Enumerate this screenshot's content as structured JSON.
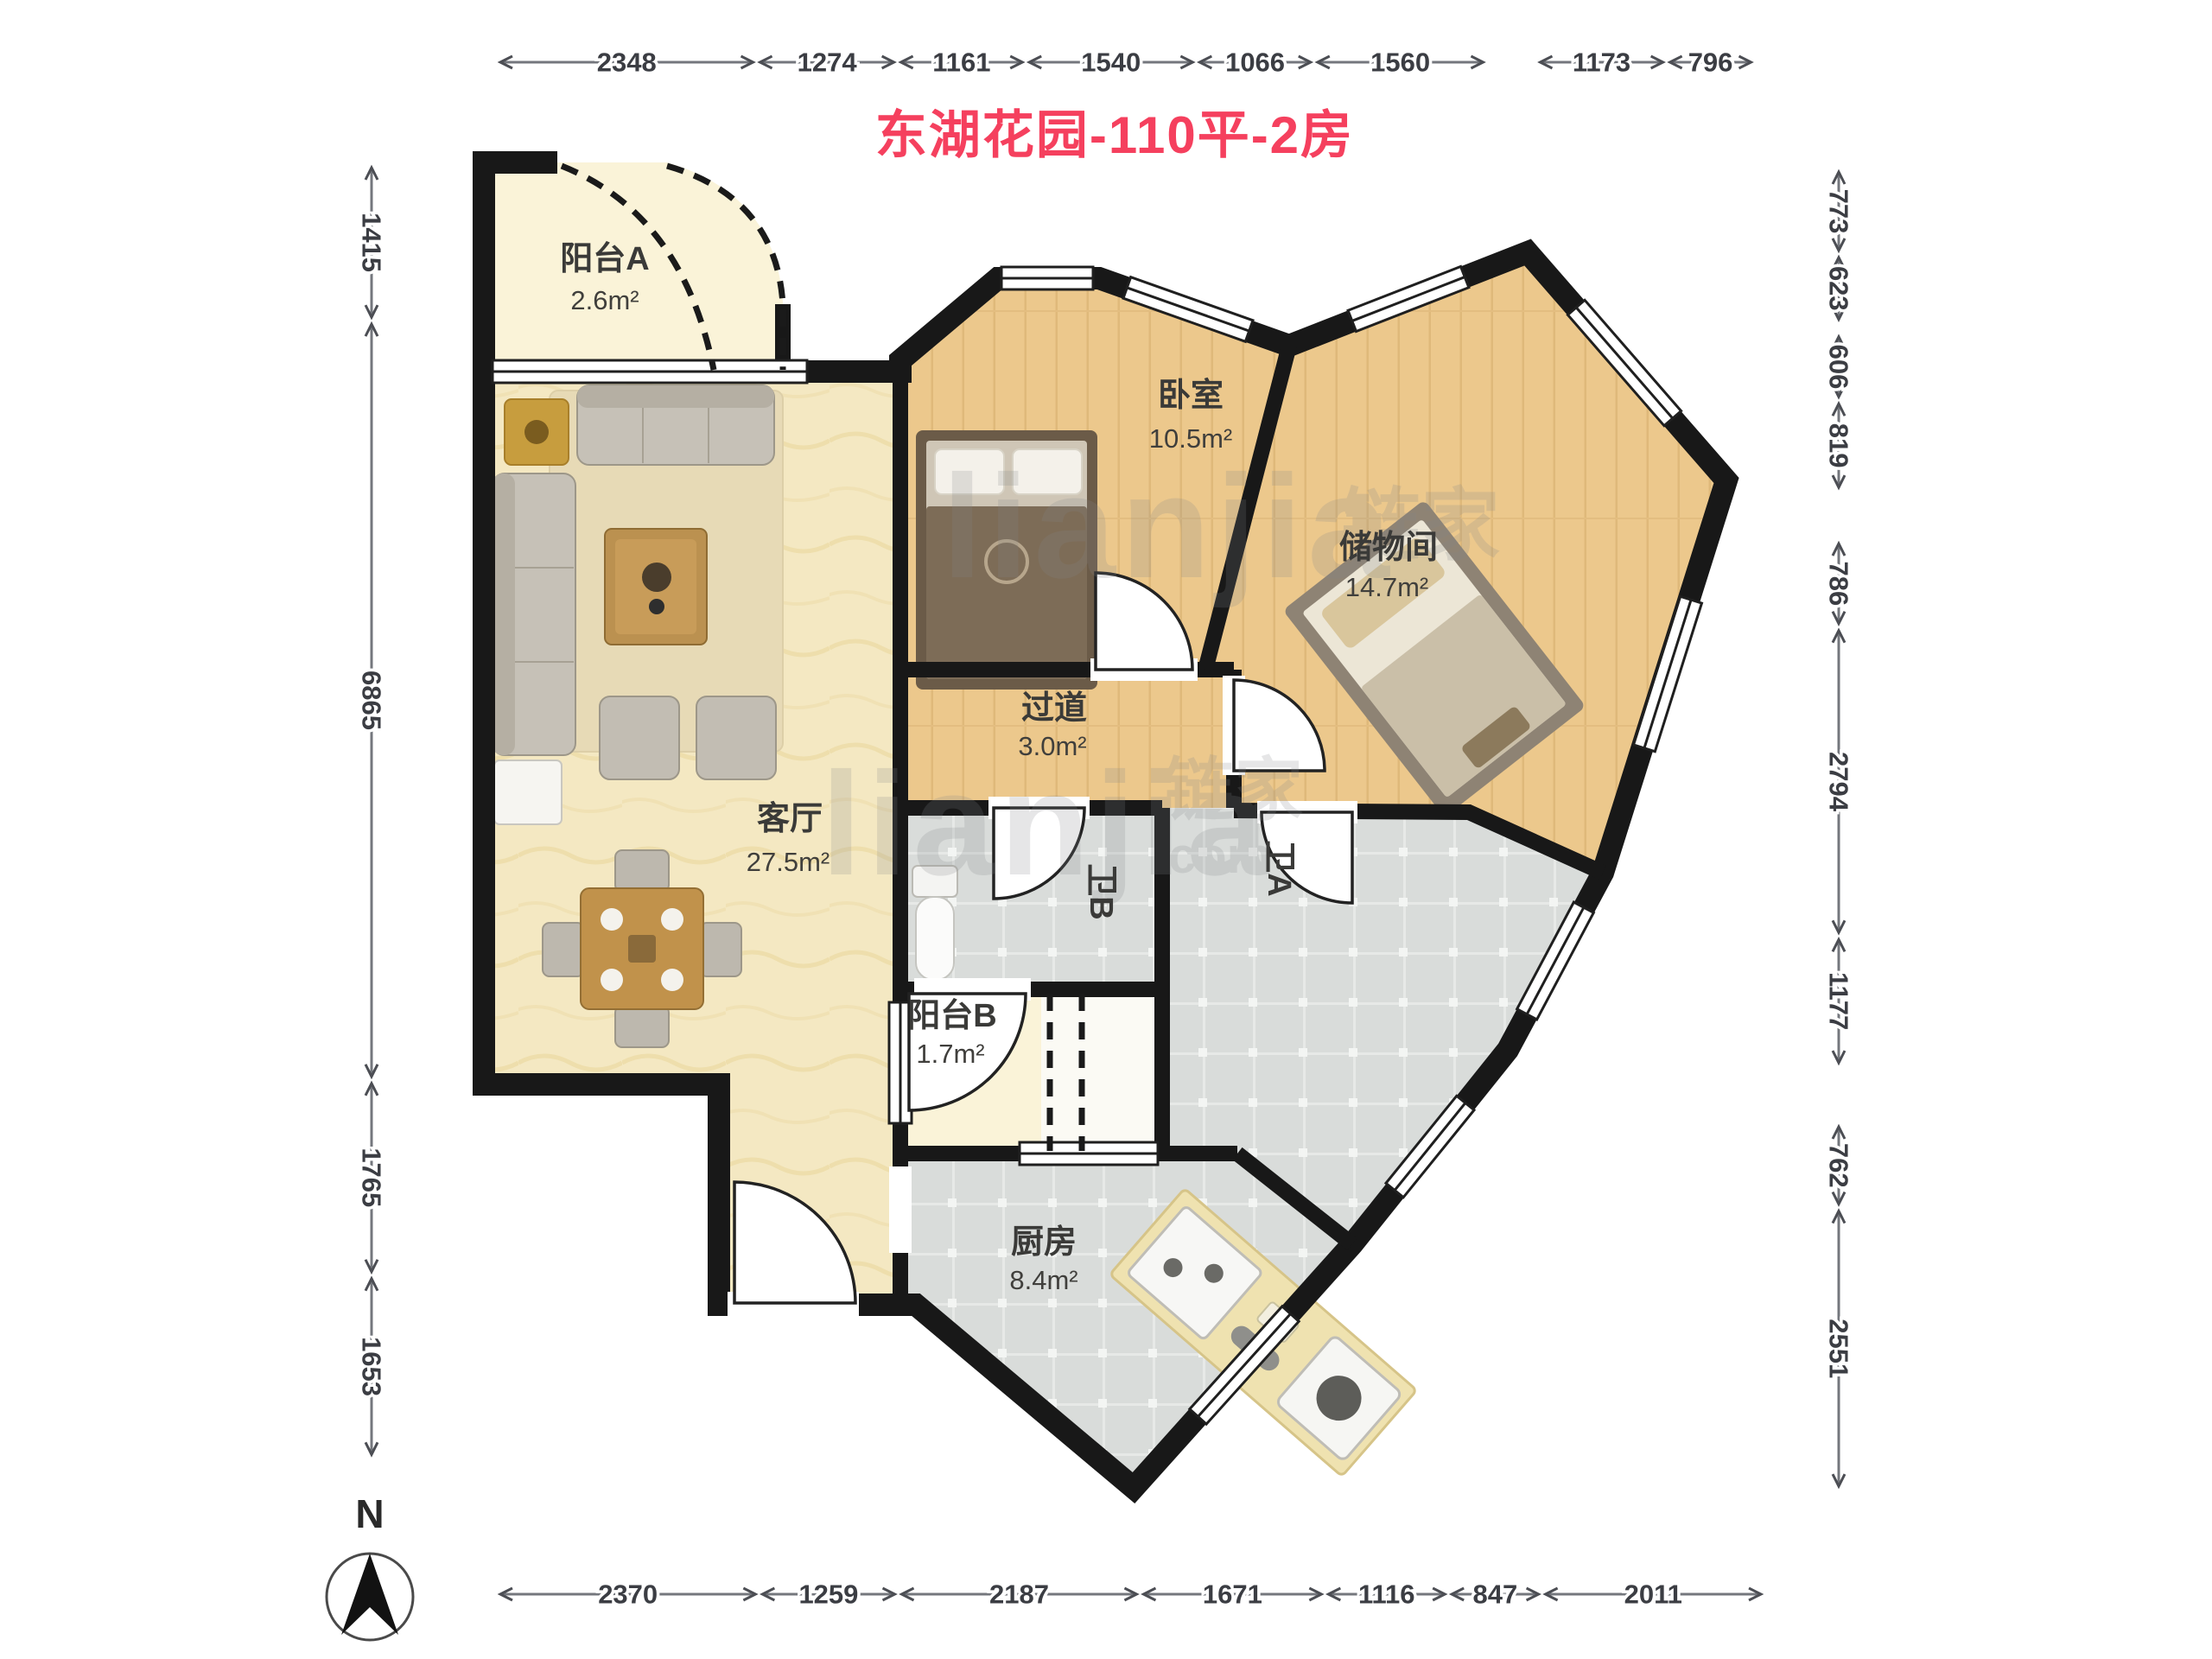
{
  "title": "东湖花园-110平-2房",
  "compass": {
    "label": "N"
  },
  "watermark": {
    "latin": "lianjia",
    "cn": "链家",
    "com": "com"
  },
  "rooms": {
    "balcony_a": {
      "name": "阳台A",
      "area": "2.6m²"
    },
    "bedroom": {
      "name": "卧室",
      "area": "10.5m²"
    },
    "storage": {
      "name": "储物间",
      "area": "14.7m²"
    },
    "hallway": {
      "name": "过道",
      "area": "3.0m²"
    },
    "living": {
      "name": "客厅",
      "area": "27.5m²"
    },
    "bath_b": {
      "name": "卫B"
    },
    "bath_a": {
      "name": "卫A"
    },
    "balcony_b": {
      "name": "阳台B",
      "area": "1.7m²"
    },
    "kitchen": {
      "name": "厨房",
      "area": "8.4m²"
    }
  },
  "dimensions_mm": {
    "top": [
      2348,
      1274,
      1161,
      1540,
      1066,
      1560,
      1173,
      796
    ],
    "left": [
      1415,
      6865,
      1765,
      1653
    ],
    "right": [
      773,
      623,
      606,
      819,
      786,
      2794,
      1177,
      762,
      2551
    ],
    "bottom": [
      2370,
      1259,
      2187,
      1671,
      1116,
      847,
      2011
    ]
  },
  "colors": {
    "title_red": "#f5405e",
    "wall": "#181818",
    "living_floor": "#f4e8c2",
    "wood_floor": "#ecc88c",
    "tile_floor": "#d9dcda",
    "balcony_floor": "#faf3d8",
    "dim_text": "#3b3d43"
  }
}
